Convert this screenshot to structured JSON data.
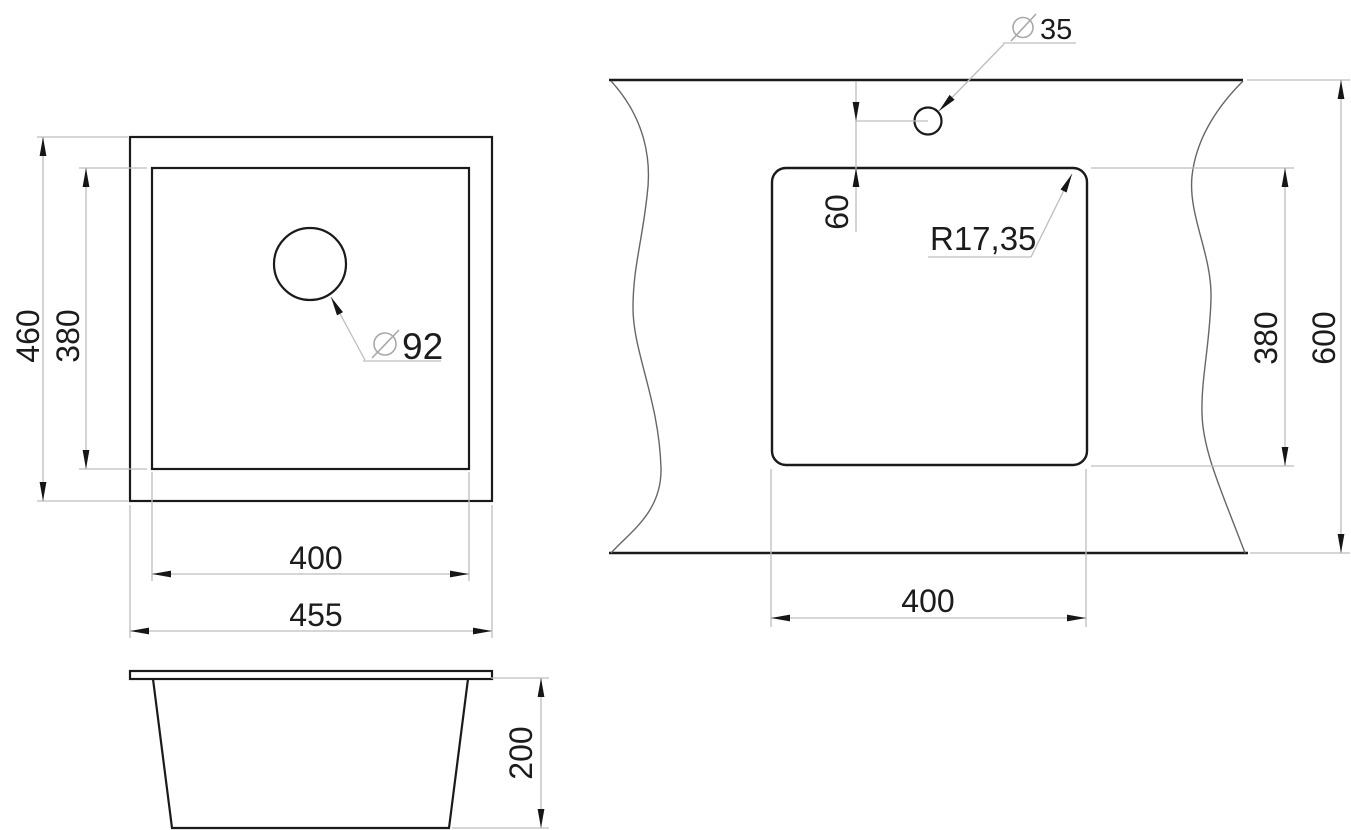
{
  "colors": {
    "background": "#ffffff",
    "object_line": "#1a1a1a",
    "thin_line": "#bdbdbd",
    "break_line": "#666666",
    "arrow": "#161616",
    "text": "#1c1c1c"
  },
  "views": {
    "top_view": {
      "labels": {
        "overall_height": "460",
        "basin_height": "380",
        "basin_width": "400",
        "overall_width": "455",
        "drain_diameter": "92"
      }
    },
    "cutout_view": {
      "labels": {
        "faucet_diameter": "35",
        "faucet_offset": "60",
        "corner_radius": "R17,35",
        "cutout_height": "380",
        "worktop_depth": "600",
        "cutout_width": "400"
      }
    },
    "side_view": {
      "labels": {
        "bowl_depth": "200"
      }
    }
  }
}
